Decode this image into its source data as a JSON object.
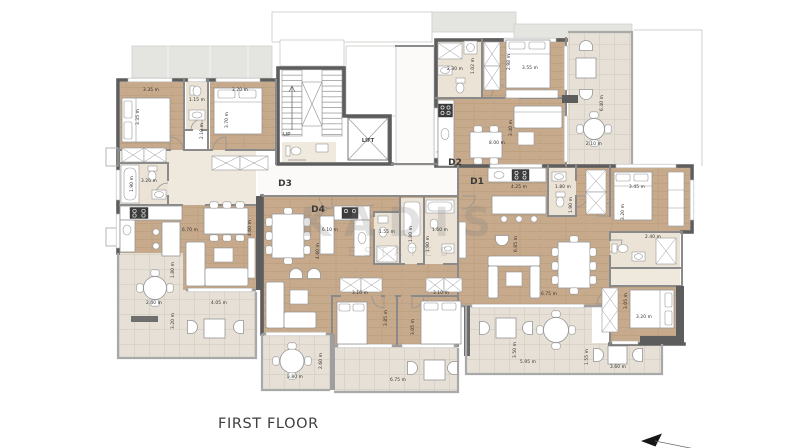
{
  "title": "FIRST FLOOR",
  "watermark": {
    "line1": "KADIS",
    "line2": "ESTATES"
  },
  "core": {
    "up": "UP",
    "lift": "LIFT"
  },
  "units": [
    {
      "id": "D3",
      "x": 285,
      "y": 186
    },
    {
      "id": "D4",
      "x": 318,
      "y": 212
    },
    {
      "id": "D2",
      "x": 455,
      "y": 165
    },
    {
      "id": "D1",
      "x": 477,
      "y": 184
    }
  ],
  "dimensions": [
    {
      "t": "3.35 m",
      "x": 151,
      "y": 91,
      "r": 0
    },
    {
      "t": "3.35 m",
      "x": 139,
      "y": 117,
      "r": 1
    },
    {
      "t": "1.15 m",
      "x": 197,
      "y": 101,
      "r": 0
    },
    {
      "t": "2.10 m",
      "x": 203,
      "y": 131,
      "r": 1
    },
    {
      "t": "3.20 m",
      "x": 240,
      "y": 91,
      "r": 0
    },
    {
      "t": "3.70 m",
      "x": 228,
      "y": 120,
      "r": 1
    },
    {
      "t": "3.20 m",
      "x": 149,
      "y": 182,
      "r": 0
    },
    {
      "t": "1.90 m",
      "x": 133,
      "y": 184,
      "r": 1
    },
    {
      "t": "6.70 m",
      "x": 190,
      "y": 231,
      "r": 0
    },
    {
      "t": "4.60 m",
      "x": 251,
      "y": 228,
      "r": 1
    },
    {
      "t": "1.80 m",
      "x": 174,
      "y": 270,
      "r": 1
    },
    {
      "t": "2.40 m",
      "x": 154,
      "y": 304,
      "r": 0
    },
    {
      "t": "4.05 m",
      "x": 219,
      "y": 304,
      "r": 0
    },
    {
      "t": "3.20 m",
      "x": 174,
      "y": 321,
      "r": 1
    },
    {
      "t": "6.10 m",
      "x": 330,
      "y": 231,
      "r": 0
    },
    {
      "t": "4.60 m",
      "x": 319,
      "y": 251,
      "r": 1
    },
    {
      "t": "1.55 m",
      "x": 387,
      "y": 233,
      "r": 0
    },
    {
      "t": "1.80 m",
      "x": 412,
      "y": 234,
      "r": 1
    },
    {
      "t": "1.60 m",
      "x": 440,
      "y": 231,
      "r": 0
    },
    {
      "t": "1.90 m",
      "x": 429,
      "y": 244,
      "r": 1
    },
    {
      "t": "3.10 m",
      "x": 360,
      "y": 294,
      "r": 0
    },
    {
      "t": "3.10 m",
      "x": 441,
      "y": 294,
      "r": 0
    },
    {
      "t": "3.85 m",
      "x": 387,
      "y": 318,
      "r": 1
    },
    {
      "t": "3.05 m",
      "x": 414,
      "y": 327,
      "r": 1
    },
    {
      "t": "6.75 m",
      "x": 398,
      "y": 381,
      "r": 0
    },
    {
      "t": "3.80 m",
      "x": 295,
      "y": 378,
      "r": 0
    },
    {
      "t": "2.60 m",
      "x": 322,
      "y": 361,
      "r": 1
    },
    {
      "t": "2.30 m",
      "x": 455,
      "y": 70,
      "r": 0
    },
    {
      "t": "1.02 m",
      "x": 474,
      "y": 66,
      "r": 1
    },
    {
      "t": "3.55 m",
      "x": 530,
      "y": 69,
      "r": 0
    },
    {
      "t": "2.98 m",
      "x": 510,
      "y": 62,
      "r": 1
    },
    {
      "t": "8.00 m",
      "x": 497,
      "y": 144,
      "r": 0
    },
    {
      "t": "3.40 m",
      "x": 512,
      "y": 128,
      "r": 1
    },
    {
      "t": "6.40 m",
      "x": 603,
      "y": 103,
      "r": 1
    },
    {
      "t": "2.10 m",
      "x": 594,
      "y": 145,
      "r": 0
    },
    {
      "t": "4.25 m",
      "x": 519,
      "y": 188,
      "r": 0
    },
    {
      "t": "1.80 m",
      "x": 563,
      "y": 188,
      "r": 0
    },
    {
      "t": "1.90 m",
      "x": 572,
      "y": 205,
      "r": 1
    },
    {
      "t": "3.45 m",
      "x": 637,
      "y": 188,
      "r": 0
    },
    {
      "t": "3.20 m",
      "x": 624,
      "y": 212,
      "r": 1
    },
    {
      "t": "2.40 m",
      "x": 653,
      "y": 238,
      "r": 0
    },
    {
      "t": "6.85 m",
      "x": 517,
      "y": 244,
      "r": 1
    },
    {
      "t": "6.75 m",
      "x": 549,
      "y": 295,
      "r": 0
    },
    {
      "t": "3.20 m",
      "x": 644,
      "y": 318,
      "r": 0
    },
    {
      "t": "3.05 m",
      "x": 627,
      "y": 301,
      "r": 1
    },
    {
      "t": "5.95 m",
      "x": 528,
      "y": 363,
      "r": 0
    },
    {
      "t": "3.50 m",
      "x": 516,
      "y": 350,
      "r": 1
    },
    {
      "t": "3.60 m",
      "x": 618,
      "y": 368,
      "r": 0
    },
    {
      "t": "1.55 m",
      "x": 588,
      "y": 357,
      "r": 1
    }
  ],
  "colors": {
    "wall": "#5d5d5d",
    "partition": "#8a8a8a",
    "parapet": "#a9a9a9",
    "wood": "#c7aa8c",
    "woodLine": "#ad8f6e",
    "hall": "#efe9dd",
    "bath": "#ebe3d6",
    "terrace": "#e6e0d6",
    "terraceLine": "#d6cfc3",
    "roof": "#e4e4e1",
    "furnStroke": "#979797",
    "text": "#2e2e2e"
  }
}
